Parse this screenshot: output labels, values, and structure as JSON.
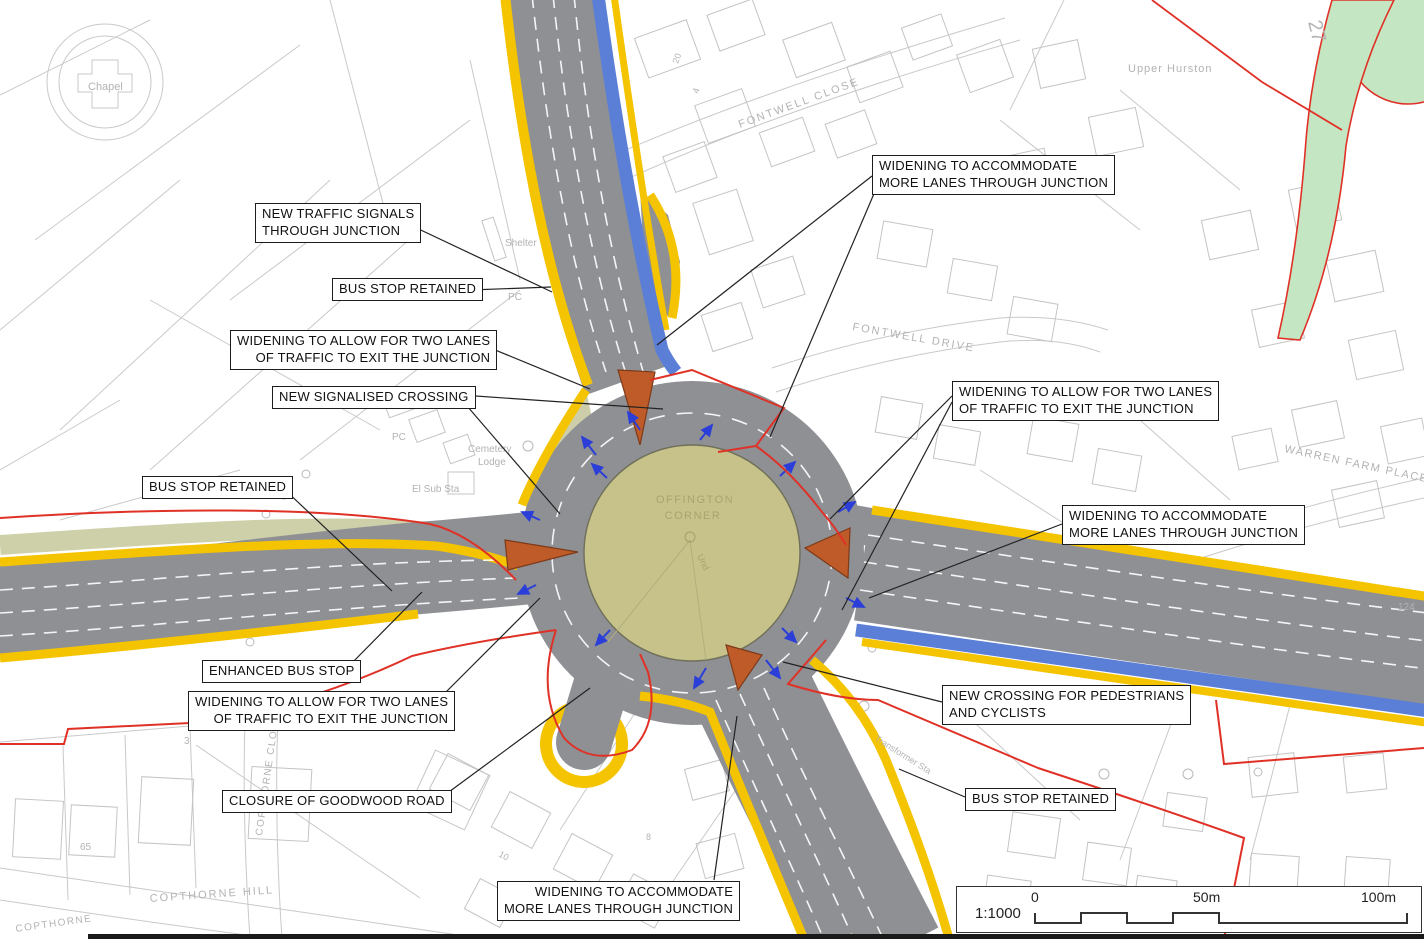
{
  "roundabout": {
    "name_line1": "OFFINGTON",
    "name_line2": "CORNER",
    "und": "Und"
  },
  "callouts": [
    {
      "id": "new-traffic-signals",
      "text": "NEW TRAFFIC SIGNALS\nTHROUGH JUNCTION"
    },
    {
      "id": "bus-stop-retained-north",
      "text": "BUS STOP RETAINED"
    },
    {
      "id": "widening-two-lanes-nw",
      "text": "WIDENING TO ALLOW FOR TWO LANES\nOF TRAFFIC TO EXIT THE JUNCTION"
    },
    {
      "id": "new-signalised-crossing",
      "text": "NEW SIGNALISED CROSSING"
    },
    {
      "id": "bus-stop-retained-west",
      "text": "BUS STOP RETAINED"
    },
    {
      "id": "enhanced-bus-stop",
      "text": "ENHANCED BUS STOP"
    },
    {
      "id": "widening-two-lanes-sw",
      "text": "WIDENING TO ALLOW FOR TWO LANES\nOF TRAFFIC TO EXIT THE JUNCTION"
    },
    {
      "id": "closure-goodwood-road",
      "text": "CLOSURE OF GOODWOOD ROAD"
    },
    {
      "id": "widening-more-lanes-south",
      "text": "WIDENING TO ACCOMMODATE\nMORE LANES THROUGH JUNCTION"
    },
    {
      "id": "widening-more-lanes-north",
      "text": "WIDENING TO ACCOMMODATE\nMORE LANES THROUGH JUNCTION"
    },
    {
      "id": "widening-two-lanes-east",
      "text": "WIDENING TO ALLOW FOR TWO LANES\nOF TRAFFIC TO EXIT THE JUNCTION"
    },
    {
      "id": "widening-more-lanes-east",
      "text": "WIDENING TO ACCOMMODATE\nMORE LANES THROUGH JUNCTION"
    },
    {
      "id": "new-crossing-ped-cycle",
      "text": "NEW CROSSING FOR PEDESTRIANS\nAND CYCLISTS"
    },
    {
      "id": "bus-stop-retained-south",
      "text": "BUS STOP RETAINED"
    }
  ],
  "map_labels": {
    "chapel": "Chapel",
    "shelter": "Shelter",
    "pc_top": "PC",
    "pc_mid": "PC",
    "cemetery_line1": "Cemetery",
    "cemetery_line2": "Lodge",
    "el_sub_sta": "El Sub Sta",
    "fontwell_close": "FONTWELL CLOSE",
    "fontwell_drive": "FONTWELL DRIVE",
    "upper_hurston": "Upper Hurston",
    "warren_farm_place": "WARREN FARM PLACE",
    "copthorne_hill": "COPTHORNE HILL",
    "copthorne_lower": "COPTHORNE",
    "copthorne_close": "COPTHORNE CLOSE",
    "transformer": "Transformer Sta",
    "a27": "27",
    "num_65": "65",
    "num_124": "124",
    "num_3": "3",
    "num_20": "20",
    "num_4": "4",
    "num_10": "10",
    "num_8": "8"
  },
  "scale_bar": {
    "ratio": "1:1000",
    "t0": "0",
    "t50": "50m",
    "t100": "100m"
  },
  "colors": {
    "road_grey": "#8e9094",
    "island_olive": "#c6c28a",
    "splitter_orange": "#bf5b28",
    "cycle_blue": "#5b7fd6",
    "kerb_yellow": "#f5c400",
    "verge_olive": "#c6c89a",
    "boundary_red": "#e03127",
    "greenspace_green": "#c5e6c2",
    "basemap_grey": "#c6c6c6"
  }
}
